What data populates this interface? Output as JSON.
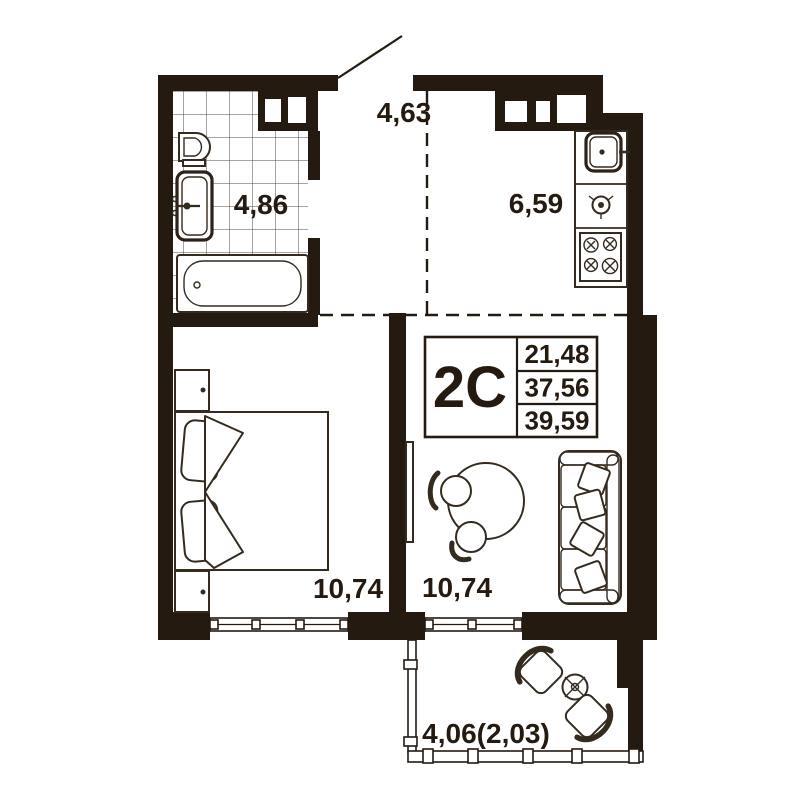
{
  "plan": {
    "title": "apartment-floor-plan",
    "unit": {
      "label": "2C",
      "values": [
        "21,48",
        "37,56",
        "39,59"
      ]
    },
    "rooms": [
      {
        "name": "hallway",
        "area": "4,63"
      },
      {
        "name": "bathroom",
        "area": "4,86"
      },
      {
        "name": "kitchen",
        "area": "6,59"
      },
      {
        "name": "bedroom",
        "area": "10,74"
      },
      {
        "name": "living-room",
        "area": "10,74"
      },
      {
        "name": "balcony",
        "area": "4,06(2,03)"
      }
    ],
    "colors": {
      "ink": "#241a10",
      "furniture_line": "#352a1e",
      "background": "#ffffff"
    }
  }
}
